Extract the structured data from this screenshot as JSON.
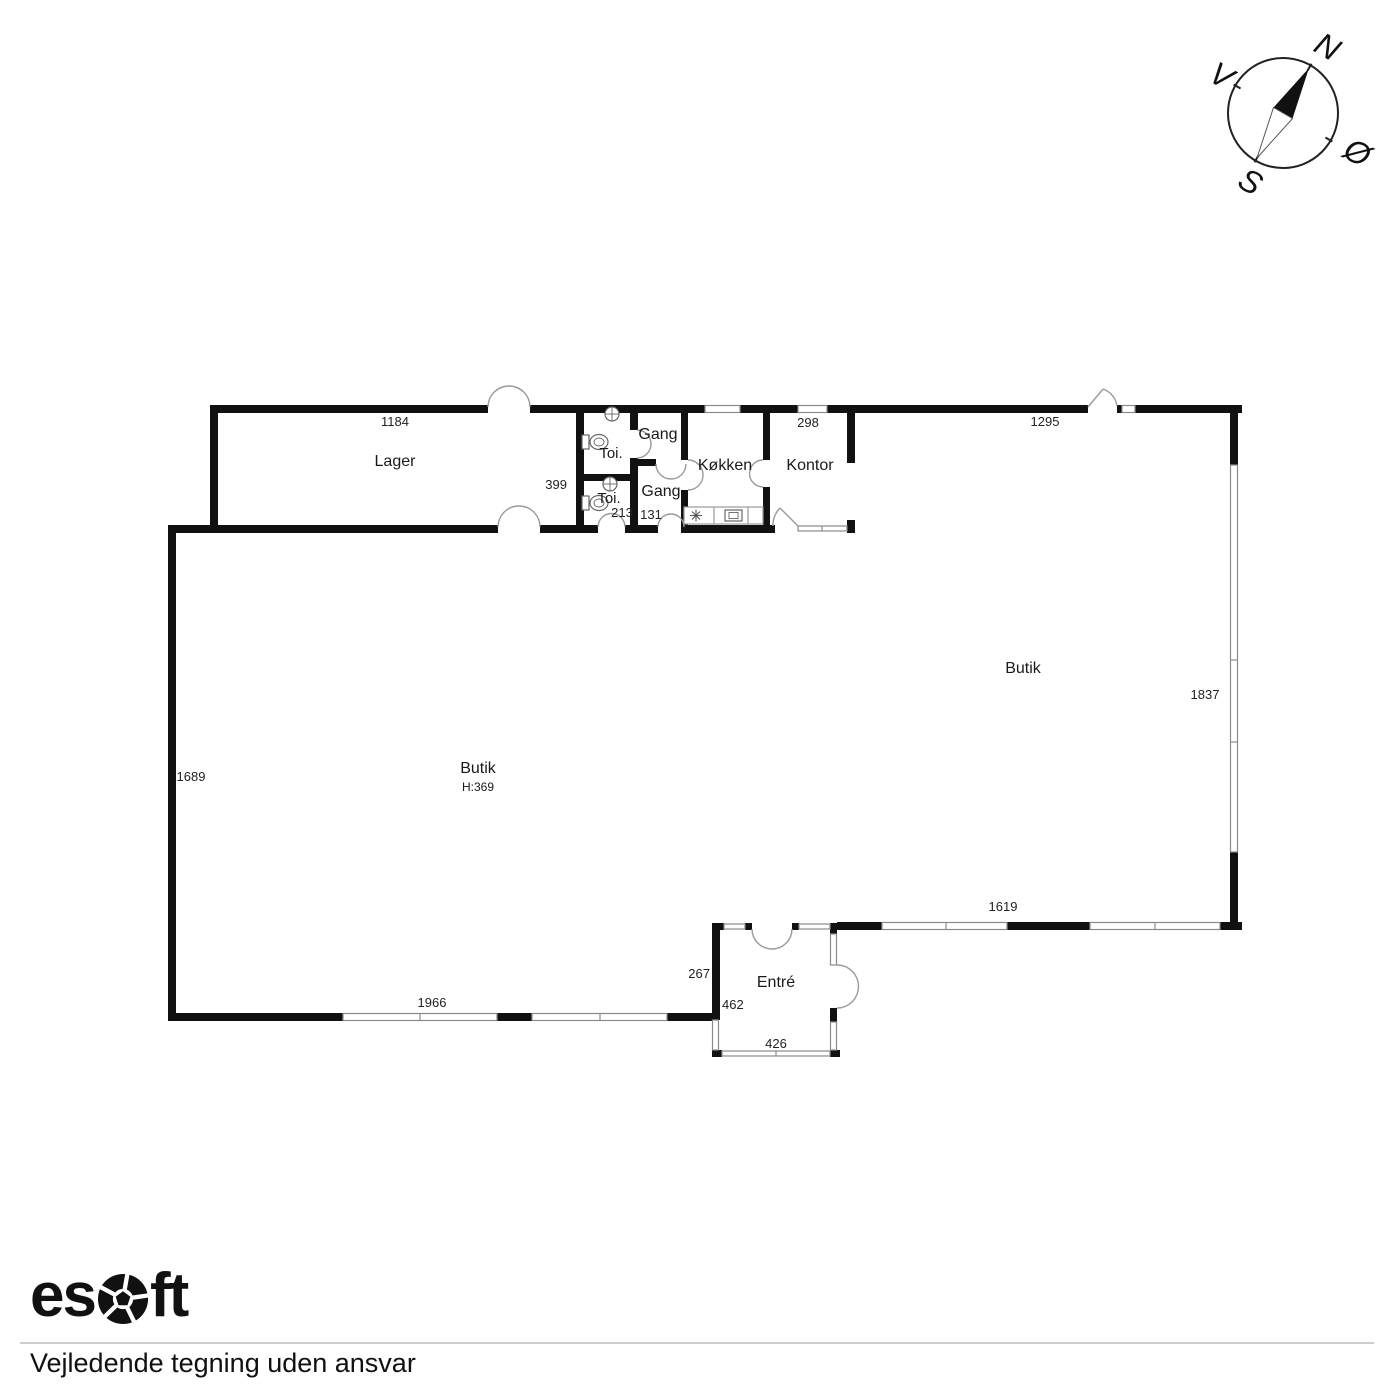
{
  "compass": {
    "n": "N",
    "e": "Ø",
    "s": "S",
    "v": "V"
  },
  "rooms": {
    "lager": {
      "label": "Lager"
    },
    "toi_upper": {
      "label": "Toi."
    },
    "toi_lower": {
      "label": "Toi."
    },
    "gang_upper": {
      "label": "Gang"
    },
    "gang_lower": {
      "label": "Gang"
    },
    "kokken": {
      "label": "Køkken"
    },
    "kontor": {
      "label": "Kontor"
    },
    "butik_right": {
      "label": "Butik"
    },
    "butik_main": {
      "label": "Butik",
      "height": "H:369"
    },
    "entre": {
      "label": "Entré"
    }
  },
  "dims": {
    "lager_top": "1184",
    "lager_side": "399",
    "toi": "213",
    "gang": "131",
    "kontor_top": "298",
    "butik_top": "1295",
    "butik_right_side": "1837",
    "butik_left_side": "1689",
    "butik_bottom": "1966",
    "butik_bottom_right": "1619",
    "entre_left_upper": "267",
    "entre_left_lower": "462",
    "entre_bottom": "426"
  },
  "colors": {
    "wall": "#111111",
    "window_line": "#8a8a8a",
    "door_line": "#9a9a9a",
    "rule": "#cccccc"
  },
  "footer": {
    "logo_left": "es",
    "logo_right": "ft",
    "disclaimer": "Vejledende tegning uden ansvar"
  }
}
